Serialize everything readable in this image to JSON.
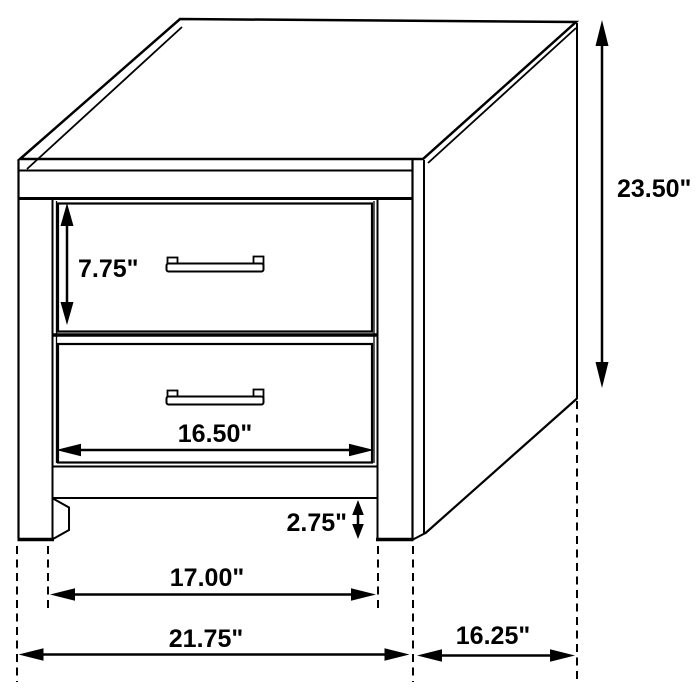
{
  "colors": {
    "line": "#000000",
    "background": "#ffffff"
  },
  "dimensions": {
    "drawer_height": "7.75\"",
    "drawer_width": "16.50\"",
    "clearance_height": "2.75\"",
    "between_legs_width": "17.00\"",
    "overall_width": "21.75\"",
    "overall_depth": "16.25\"",
    "overall_height": "23.50\""
  }
}
